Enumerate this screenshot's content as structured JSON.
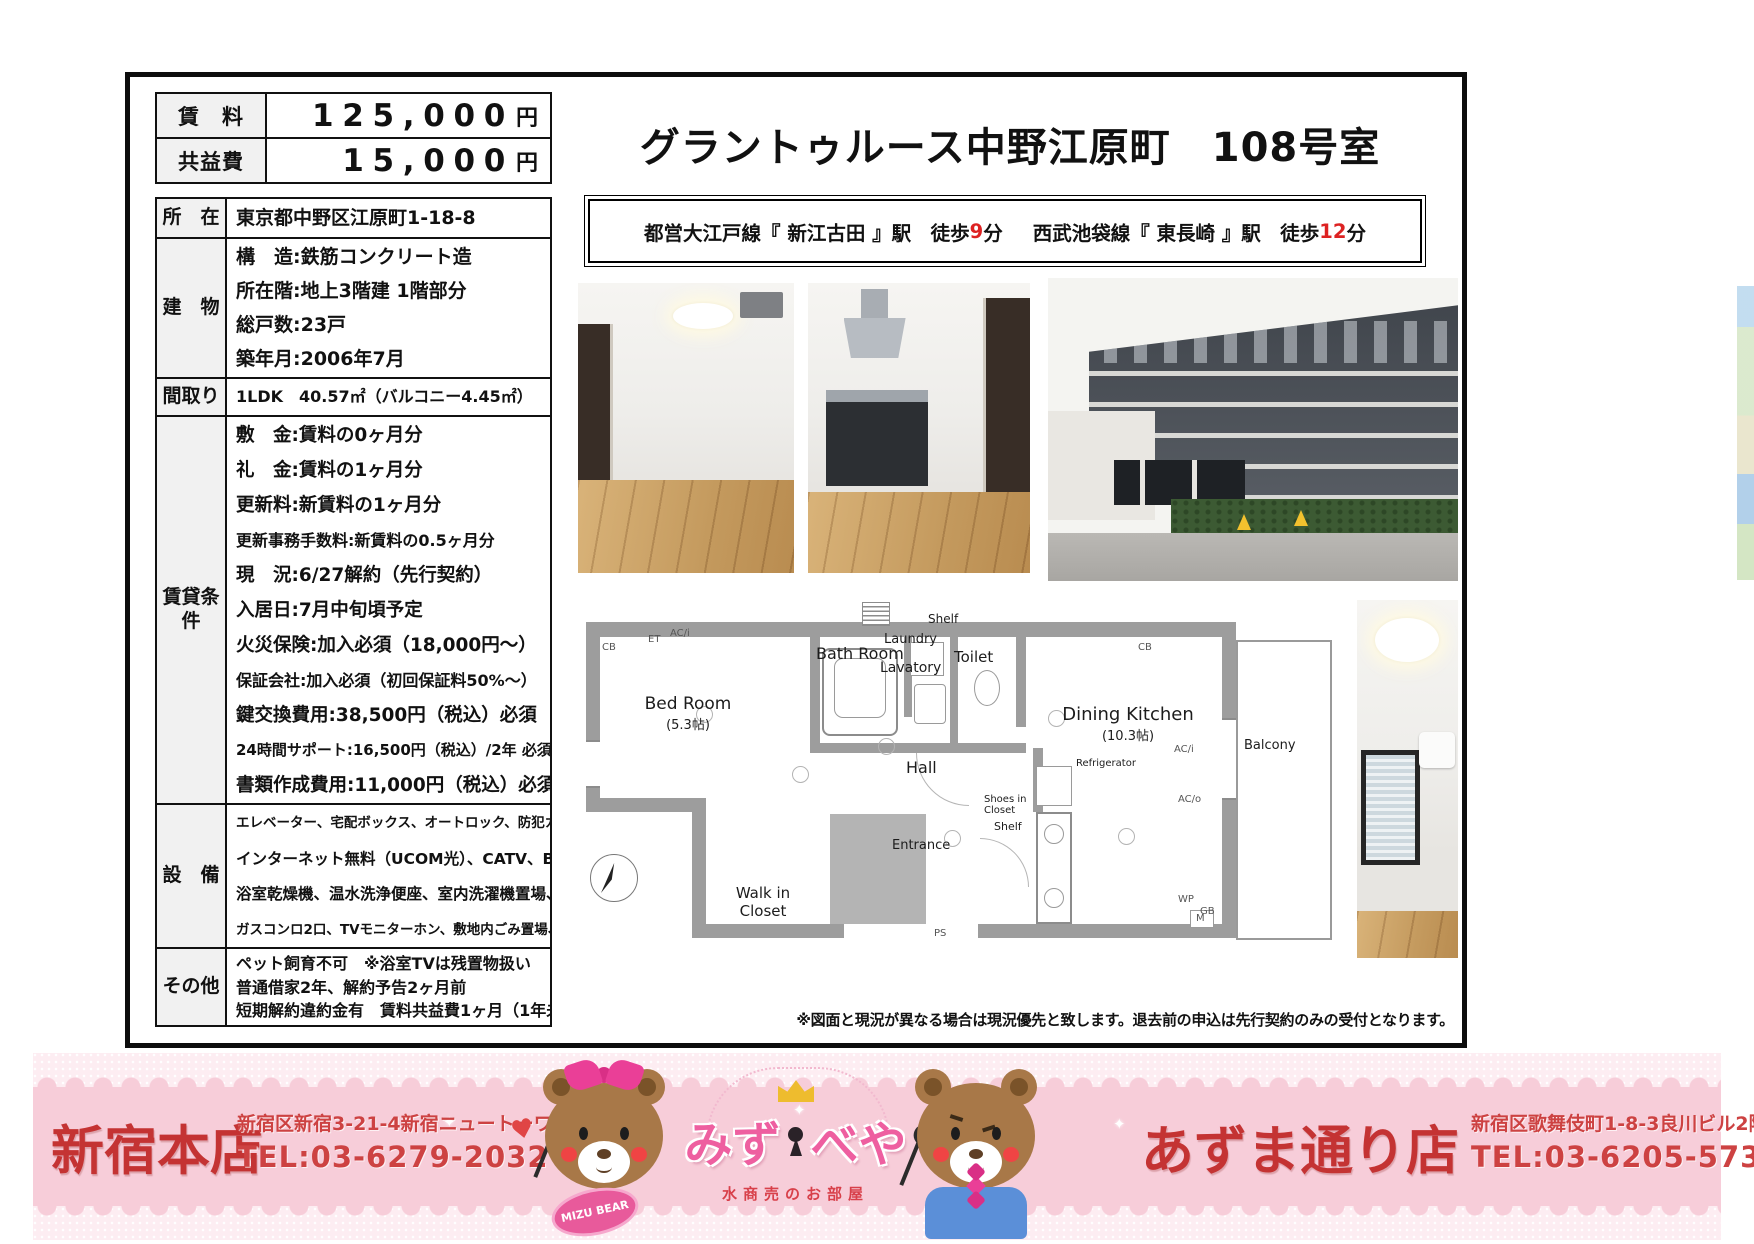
{
  "header": {
    "title": "グラントゥルース中野江原町　108号室"
  },
  "access": {
    "line1_text": "都営大江戸線『 新江古田 』駅　徒歩",
    "line1_min": "9",
    "min_unit": "分",
    "line2_text": "西武池袋線『 東長崎 』駅　徒歩",
    "line2_min": "12"
  },
  "price_table": {
    "rows": [
      {
        "label": "賃　料",
        "value": "125,000",
        "unit": "円"
      },
      {
        "label": "共益費",
        "value": "15,000",
        "unit": "円"
      }
    ]
  },
  "spec_table": {
    "rows": [
      {
        "label": "所　在",
        "lines": [
          "東京都中野区江原町1-18-8"
        ]
      },
      {
        "label": "建　物",
        "lines": [
          "構　造:鉄筋コンクリート造",
          "所在階:地上3階建 1階部分",
          "総戸数:23戸",
          "築年月:2006年7月"
        ]
      },
      {
        "label": "間取り",
        "lines": [
          "1LDK　40.57㎡（バルコニー4.45㎡）"
        ]
      },
      {
        "label": "賃貸条件",
        "lines": [
          "敷　金:賃料の0ヶ月分",
          "礼　金:賃料の1ヶ月分",
          "更新料:新賃料の1ヶ月分",
          "更新事務手数料:新賃料の0.5ヶ月分",
          "現　況:6/27解約（先行契約）",
          "入居日:7月中旬頃予定",
          "火災保険:加入必須（18,000円～）",
          "保証会社:加入必須（初回保証料50%～）",
          "鍵交換費用:38,500円（税込）必須",
          "24時間サポート:16,500円（税込）/2年 必須",
          "書類作成費用:11,000円（税込）必須"
        ]
      },
      {
        "label": "設　備",
        "lines": [
          "エレベーター、宅配ボックス、オートロック、防犯カメラ",
          "インターネット無料（UCOM光）、CATV、BS/110°CS",
          "浴室乾燥機、温水洗浄便座、室内洗濯機置場、エアコン",
          "ガスコンロ2口、TVモニターホン、敷地内ごみ置場、バルコニー"
        ]
      },
      {
        "label": "その他",
        "lines": [
          "ペット飼育不可　※浴室TVは残置物扱い",
          "普通借家2年、解約予告2ヶ月前",
          "短期解約違約金有　賃料共益費1ヶ月（1年未満）"
        ]
      }
    ]
  },
  "disclaimer": "※図面と現況が異なる場合は現況優先と致します。退去前の申込は先行契約のみの受付となります。",
  "floorplan": {
    "bedroom": "Bed Room",
    "bedroom_size": "(5.3帖)",
    "bathroom": "Bath Room",
    "laundry": "Laundry",
    "lavatory": "Lavatory",
    "toilet": "Toilet",
    "shelf": "Shelf",
    "dining": "Dining Kitchen",
    "dining_size": "(10.3帖)",
    "hall": "Hall",
    "refrigerator": "Refrigerator",
    "shoes_closet": "Shoes in Closet",
    "walkin_closet1": "Walk in",
    "walkin_closet2": "Closet",
    "entrance": "Entrance",
    "balcony": "Balcony",
    "ann_cb": "CB",
    "ann_aci": "AC/i",
    "ann_aco": "AC/o",
    "ann_et": "ET",
    "ann_m": "M",
    "ann_ps": "PS",
    "ann_wp": "WP",
    "ann_gb": "GB"
  },
  "footer": {
    "store1": {
      "name": "新宿本店",
      "address": "新宿区新宿3-21-4新宿ニュートーワビル1階",
      "tel": "TEL:03-6279-2032"
    },
    "logo": {
      "part1": "みず",
      "part2": "べや",
      "sub": "水商売のお部屋",
      "badge": "MIZU BEAR"
    },
    "store2": {
      "name": "あずま通り店",
      "address": "新宿区歌舞伎町1-8-3良川ビル2階",
      "tel": "TEL:03-6205-5732"
    }
  },
  "icons": {
    "heart": "♥",
    "sparkle": "✦"
  }
}
